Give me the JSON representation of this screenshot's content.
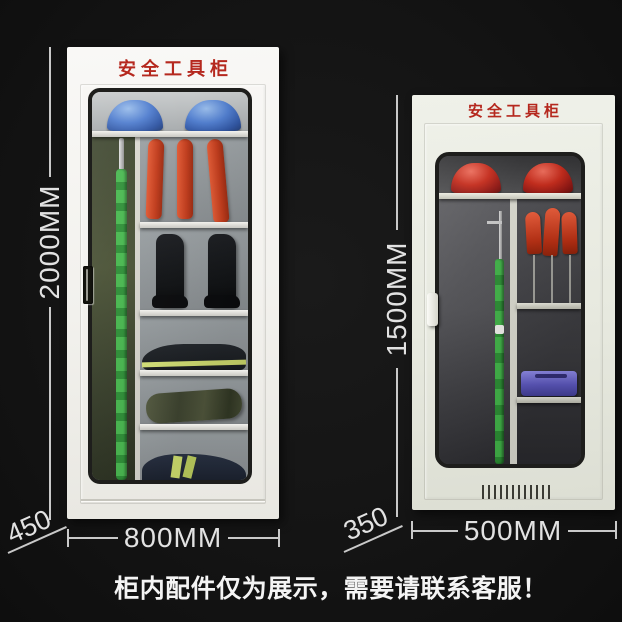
{
  "page": {
    "background_color": "#141414",
    "caption": "柜内配件仅为展示，需要请联系客服！"
  },
  "left_cabinet": {
    "title": "安全工具柜",
    "dimensions": {
      "height": "2000MM",
      "width": "800MM",
      "depth": "450"
    },
    "body_color": "#f2f1ed",
    "contents": [
      "blue safety helmet x2",
      "insulated operating rod",
      "insulated gloves x3",
      "insulating boots x2",
      "folded workwear with reflective stripe",
      "tool duffel bag",
      "folded workwear with reflective stripes"
    ]
  },
  "right_cabinet": {
    "title": "安全工具柜",
    "dimensions": {
      "height": "1500MM",
      "width": "500MM",
      "depth": "350"
    },
    "body_color": "#e7e9df",
    "contents": [
      "red safety helmet x2",
      "insulated operating rod",
      "insulated gloves x3 on stands",
      "blue tool box",
      "ventilation grille"
    ]
  },
  "colors": {
    "title_red": "#b5281e",
    "dimension_text": "#e2e2e2",
    "helmet_blue": "#4e7cce",
    "helmet_red": "#c22818",
    "glove_red": "#c03a1a",
    "rod_green": "#3fae46",
    "toolbox_blue": "#5b56ba"
  }
}
